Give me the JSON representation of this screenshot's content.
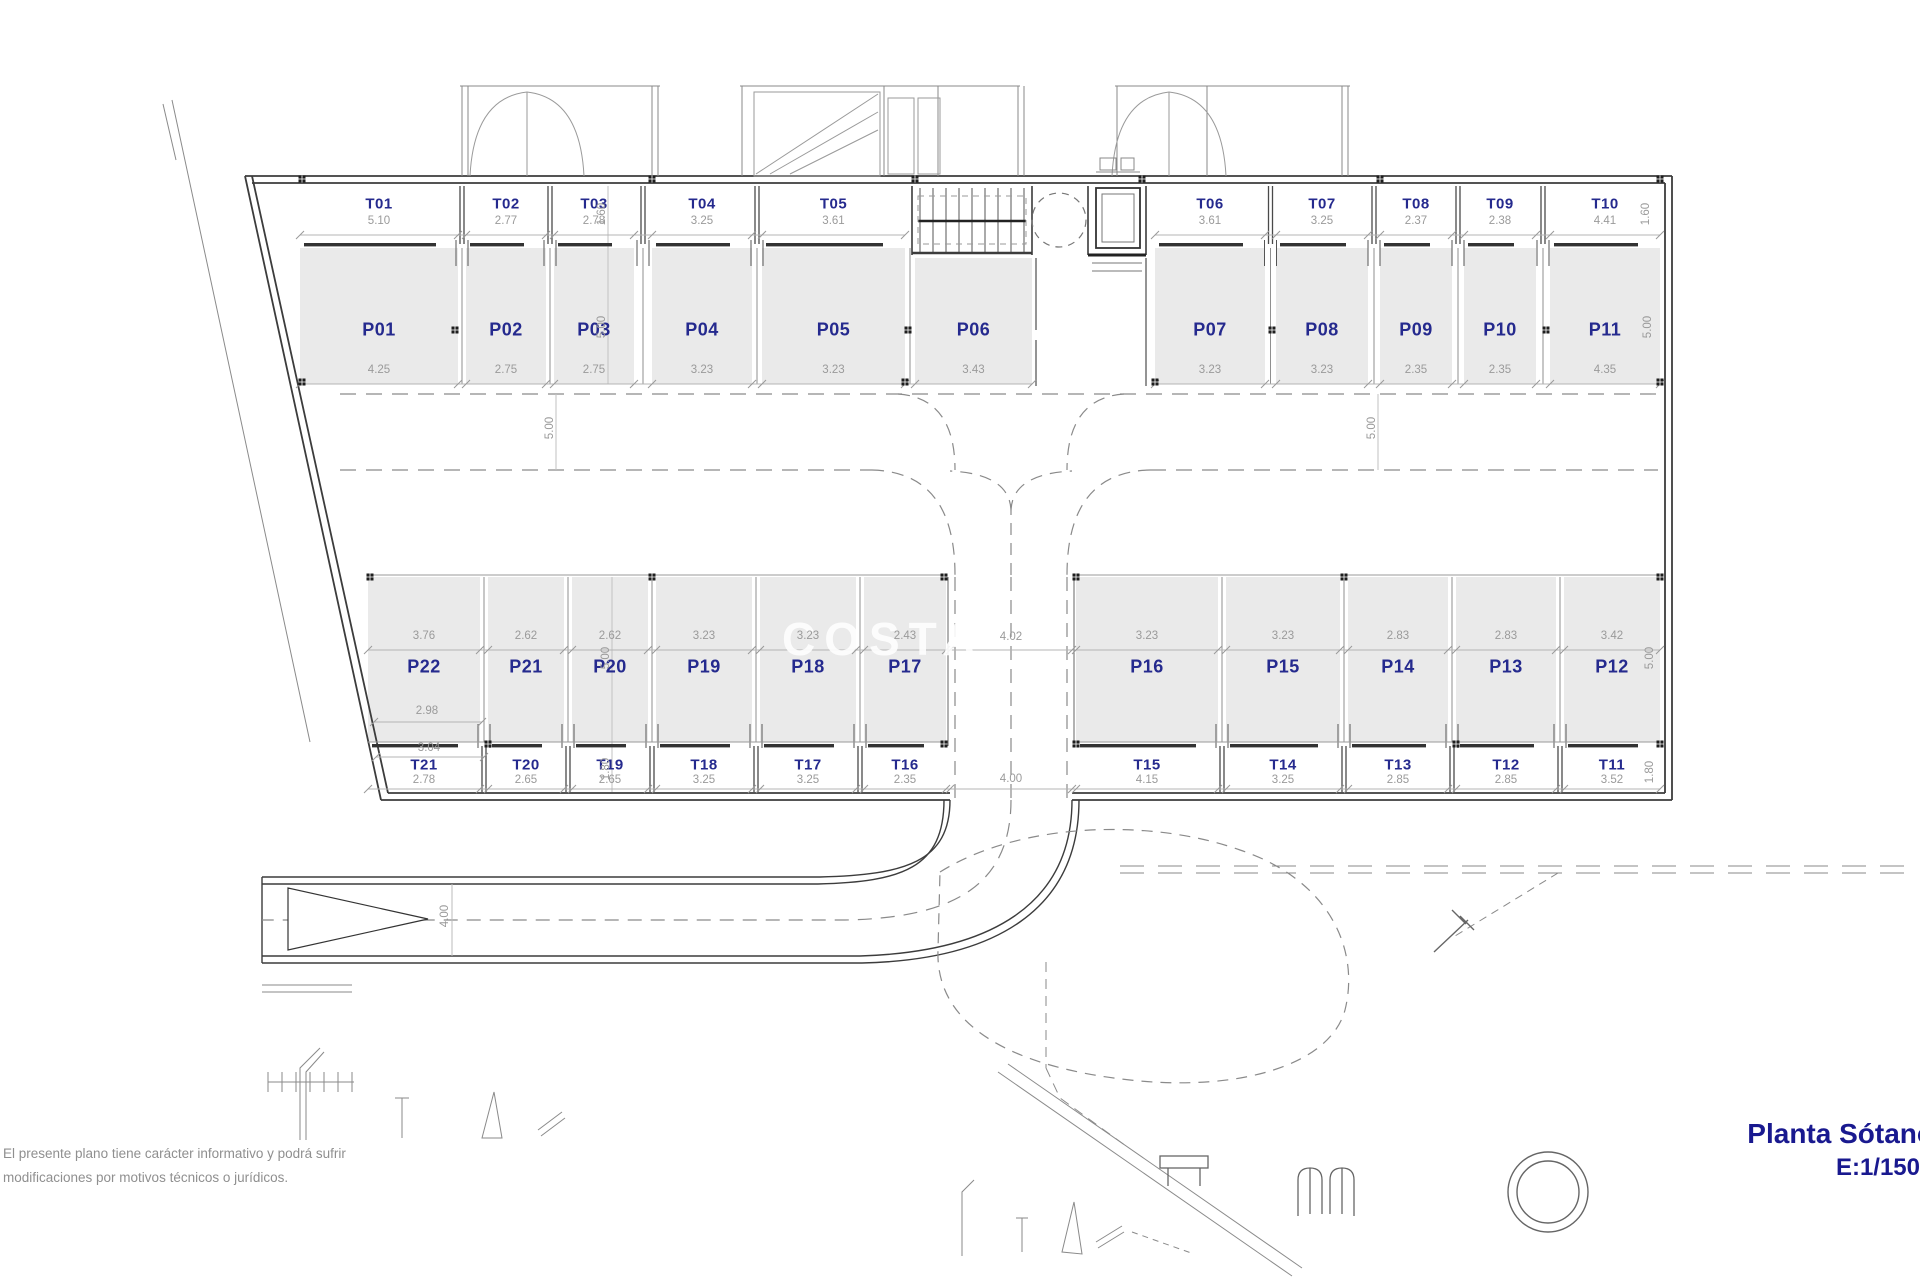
{
  "plan": {
    "title_line1": "Planta Sótano",
    "title_line2": "E:1/150",
    "disclaimer_line1": "El presente plano tiene carácter informativo y podrá sufrir",
    "disclaimer_line2": "modificaciones por motivos técnicos o jurídicos.",
    "watermark": "COSTA"
  },
  "colors": {
    "label_blue": "#252a8e",
    "title_blue": "#19198f",
    "dim_gray": "#9a9a9a",
    "stall_fill": "#eaeaea",
    "wall_dark": "#3c3c3c"
  },
  "top_row": {
    "trasteros": [
      {
        "id": "T01",
        "dim": "5.10"
      },
      {
        "id": "T02",
        "dim": "2.77"
      },
      {
        "id": "T03",
        "dim": "2.78"
      },
      {
        "id": "T04",
        "dim": "3.25"
      },
      {
        "id": "T05",
        "dim": "3.61"
      },
      {
        "id": "T06",
        "dim": "3.61"
      },
      {
        "id": "T07",
        "dim": "3.25"
      },
      {
        "id": "T08",
        "dim": "2.37"
      },
      {
        "id": "T09",
        "dim": "2.38"
      },
      {
        "id": "T10",
        "dim": "4.41"
      }
    ],
    "parkings": [
      {
        "id": "P01",
        "dim": "4.25"
      },
      {
        "id": "P02",
        "dim": "2.75"
      },
      {
        "id": "P03",
        "dim": "2.75"
      },
      {
        "id": "P04",
        "dim": "3.23"
      },
      {
        "id": "P05",
        "dim": "3.23"
      },
      {
        "id": "P06",
        "dim": "3.43"
      },
      {
        "id": "P07",
        "dim": "3.23"
      },
      {
        "id": "P08",
        "dim": "3.23"
      },
      {
        "id": "P09",
        "dim": "2.35"
      },
      {
        "id": "P10",
        "dim": "2.35"
      },
      {
        "id": "P11",
        "dim": "4.35"
      }
    ]
  },
  "bottom_row": {
    "parkings": [
      {
        "id": "P22",
        "dim": "3.76"
      },
      {
        "id": "P21",
        "dim": "2.62"
      },
      {
        "id": "P20",
        "dim": "2.62"
      },
      {
        "id": "P19",
        "dim": "3.23"
      },
      {
        "id": "P18",
        "dim": "3.23"
      },
      {
        "id": "P17",
        "dim": "2.43"
      },
      {
        "id": "P16",
        "dim": "3.23"
      },
      {
        "id": "P15",
        "dim": "3.23"
      },
      {
        "id": "P14",
        "dim": "2.83"
      },
      {
        "id": "P13",
        "dim": "2.83"
      },
      {
        "id": "P12",
        "dim": "3.42"
      }
    ],
    "trasteros": [
      {
        "id": "T21",
        "dim": "2.78"
      },
      {
        "id": "T20",
        "dim": "2.65"
      },
      {
        "id": "T19",
        "dim": "2.65"
      },
      {
        "id": "T18",
        "dim": "3.25"
      },
      {
        "id": "T17",
        "dim": "3.25"
      },
      {
        "id": "T16",
        "dim": "2.35"
      },
      {
        "id": "T15",
        "dim": "4.15"
      },
      {
        "id": "T14",
        "dim": "3.25"
      },
      {
        "id": "T13",
        "dim": "2.85"
      },
      {
        "id": "T12",
        "dim": "2.85"
      },
      {
        "id": "T11",
        "dim": "3.52"
      }
    ]
  },
  "dims": {
    "top_t_depth_left": "1.60",
    "top_p_depth_left": "5.00",
    "top_t_depth_right": "1.60",
    "top_p_depth_right": "5.00",
    "aisle_left": "5.00",
    "aisle_right": "5.00",
    "bottom_p_depth_left": "5.00",
    "bottom_t_depth_left": "1.80",
    "bottom_p_depth_right": "5.00",
    "bottom_t_depth_right": "1.80",
    "p22_width_mid": "2.98",
    "p22_width_low": "3.04",
    "ramp_width_top": "4.02",
    "ramp_width_bottom": "4.00",
    "road_width": "4.00"
  }
}
